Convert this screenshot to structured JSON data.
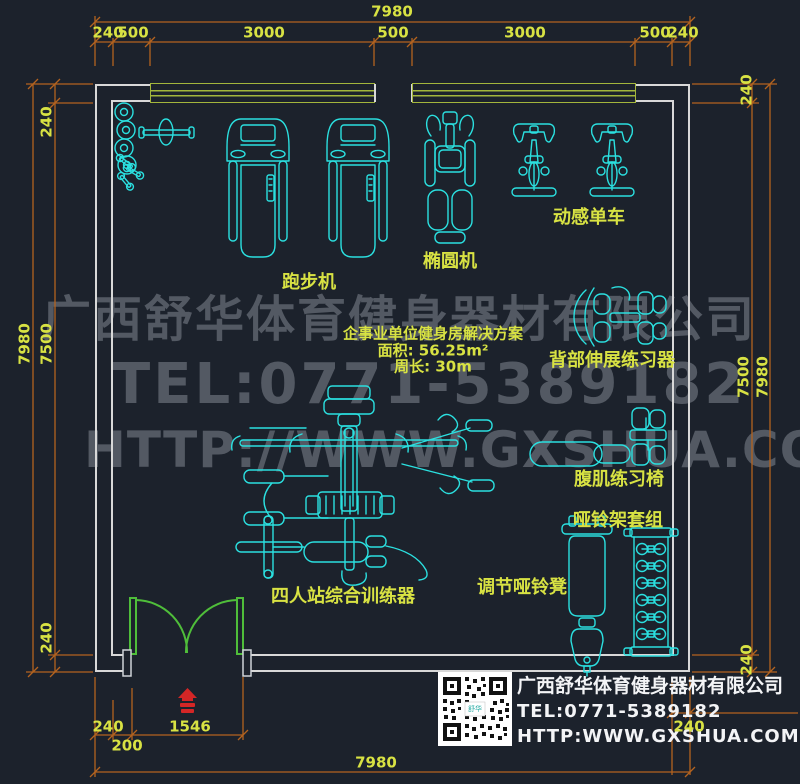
{
  "plan_info": {
    "title": "企事业单位健身房解决方案",
    "area": "面积: 56.25m²",
    "perimeter": "周长: 30m"
  },
  "equipment_labels": {
    "treadmill": "跑步机",
    "elliptical": "椭圆机",
    "spin_bike": "动感单车",
    "back_extension": "背部伸展练习器",
    "ab_chair": "腹肌练习椅",
    "dumbbell_rack": "哑铃架套组",
    "dumbbell_bench": "调节哑铃凳",
    "multi_trainer": "四人站综合训练器"
  },
  "dimensions": {
    "top": {
      "total": "7980",
      "segments": [
        "240",
        "500",
        "3000",
        "500",
        "3000",
        "500",
        "240"
      ]
    },
    "left": {
      "total": "7980",
      "inner": "7500",
      "top_wall": "240",
      "bottom_wall": "240"
    },
    "right": {
      "total": "7980",
      "inner": "7500",
      "top_wall": "240",
      "bottom_wall": "240"
    },
    "bottom": {
      "wall": "240",
      "offset": "200",
      "door": "1546",
      "total": "7980",
      "right_wall": "240"
    }
  },
  "watermark": {
    "company": "广西舒华体育健身器材有限公司",
    "tel": "TEL:0771-5389182",
    "url": "HTTP://WWW.GXSHUA.COM"
  },
  "footer": {
    "company": "广西舒华体育健身器材有限公司",
    "tel": "TEL:0771-5389182",
    "url": "HTTP:WWW.GXSHUA.COM",
    "qr_logo": "舒华"
  },
  "colors": {
    "background": "#1c222c",
    "equipment_line": "#2be0e0",
    "text_yellow": "#d8e243",
    "dimension_line": "#b4631f",
    "wall": "#d8d8d8",
    "window": "#a3b63c",
    "door": "#4fbe3a",
    "entry_marker": "#d42626"
  }
}
